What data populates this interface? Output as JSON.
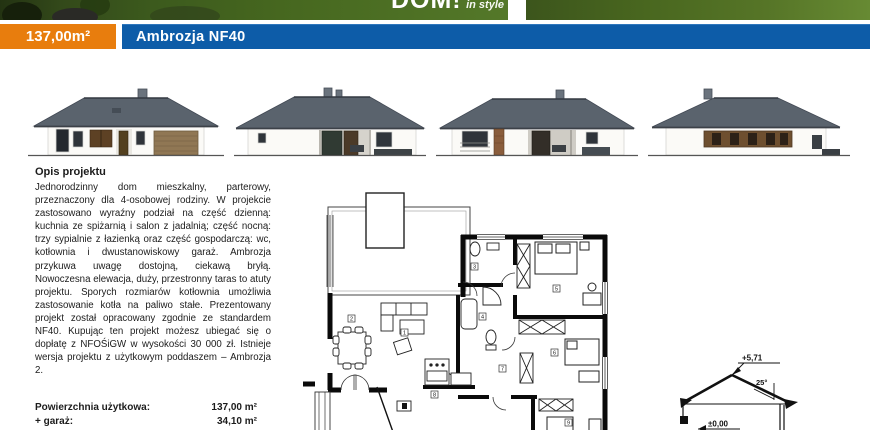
{
  "banner": {
    "logo_main": "DOM!",
    "logo_sub": "in style"
  },
  "header": {
    "area_badge": "137,00m²",
    "title": "Ambrozja NF40",
    "accent_orange": "#e87d0d",
    "accent_blue": "#0d5ca8"
  },
  "elevations": {
    "items": [
      "front-elevation-garage",
      "side-elevation-terrace",
      "rear-elevation-porch",
      "side-elevation-window-band"
    ]
  },
  "description": {
    "heading": "Opis projektu",
    "body": "Jednorodzinny dom mieszkalny, parterowy, przeznaczony dla 4-osobowej rodziny. W projekcie zastosowano wyraźny podział na część dzienną: kuchnia ze spiżarnią i salon z jadalnią; część nocną: trzy sypialnie z łazienką oraz część gospodarczą: wc, kotłownia i dwustanowiskowy garaż. Ambrozja przykuwa uwagę dostojną, ciekawą bryłą. Nowoczesna elewacja, duży, przestronny taras to atuty projektu. Sporych rozmiarów kotłownia umożliwia zastosowanie kotła na paliwo stałe. Prezentowany projekt został opracowany zgodnie ze standardem NF40. Kupując ten projekt możesz ubiegać się o dopłatę z NFOŚiGW w wysokości 30 000 zł. Istnieje wersja projektu z użytkowym poddaszem – Ambrozja 2."
  },
  "stats": {
    "rows": [
      {
        "label": "Powierzchnia użytkowa:",
        "value": "137,00 m²"
      },
      {
        "label": "+ garaż:",
        "value": "34,10 m²"
      }
    ]
  },
  "section": {
    "ridge_height": "+5,71",
    "roof_angle": "25°",
    "floor_level": "±0,00"
  }
}
